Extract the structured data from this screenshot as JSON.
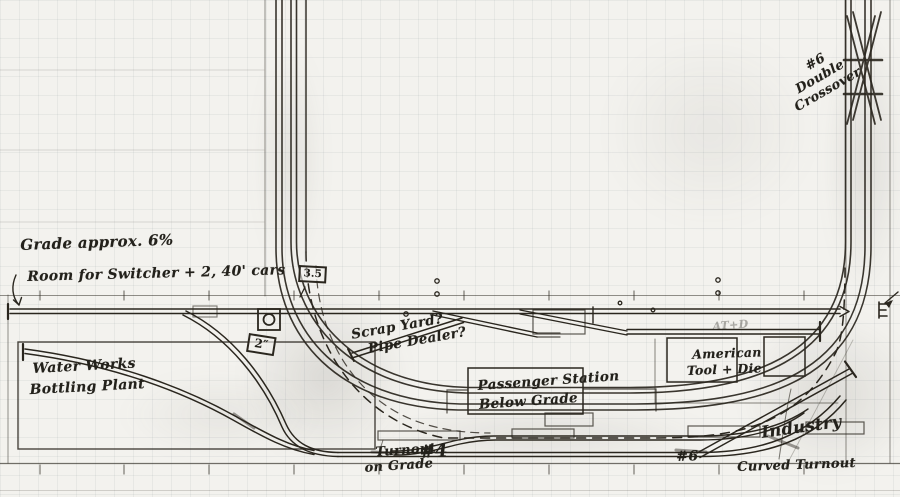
{
  "sketch": {
    "title": "Model railroad shelf-layout pencil sketch on graph paper",
    "ink_color": "#2a261e",
    "paper_color": "#f3f2ee",
    "grid_color": "#949ea6"
  },
  "notes": {
    "grade": "Grade approx. 6%",
    "room": "Room for Switcher + 2, 40' cars"
  },
  "structures": {
    "water_works": [
      "Water Works",
      "Bottling Plant"
    ],
    "passenger_station": [
      "Passenger Station",
      "Below Grade"
    ],
    "american_tool": [
      "American",
      "Tool + Die"
    ],
    "american_tool_scribble": "AT+D"
  },
  "track_labels": {
    "scrap_yard": [
      "Scrap Yard?",
      "Pipe Dealer?"
    ],
    "industry": "Industry",
    "turnout_on_grade": {
      "line1": "Turnout",
      "line2": "on Grade",
      "number": "#4"
    },
    "turnout_number": "#6",
    "curved_turnout": "Curved Turnout",
    "double_crossover": [
      "#6",
      "Double",
      "Crossover"
    ]
  },
  "elevation_markers": {
    "hidden_main": "3.5",
    "water_works_spur": "2″"
  },
  "icons": {
    "room_note_arrow": "curved-down-arrow",
    "staging_arrow": "left-arrow",
    "shelf_track_end": "arrow-tip",
    "track_bumpers": "end-bar"
  }
}
